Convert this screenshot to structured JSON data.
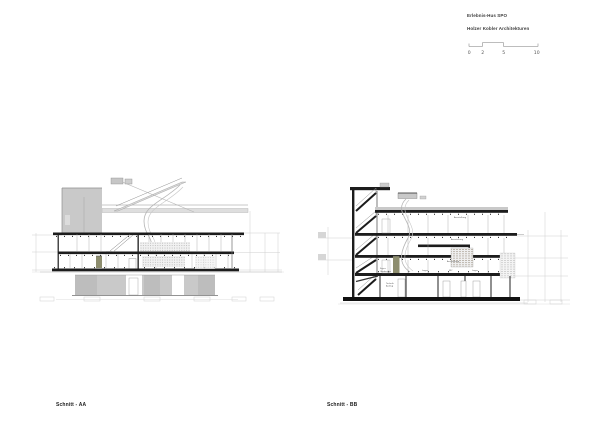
{
  "sheet": {
    "background": "#ffffff"
  },
  "header": {
    "project_title": "Erlebnis-Hus SPO",
    "firm": "Holzer Kobler Architekturen",
    "scale_bar": {
      "ticks": [
        "0",
        "2",
        "5",
        "10"
      ]
    }
  },
  "drawings": {
    "aa": {
      "caption": "Schnitt - AA"
    },
    "bb": {
      "caption": "Schnitt - BB",
      "floor_labels": [
        "Ausstellung",
        "Ausstellung",
        "Ausstellung"
      ],
      "room_labels": [
        "Foyer",
        "Garderobe",
        "Lager",
        "WC",
        "Lager"
      ],
      "basement_labels": [
        "Technik",
        "Aufzug"
      ]
    }
  },
  "colors": {
    "ink": "#1c1c1c",
    "concrete": "#c9c9c9",
    "concrete-dark": "#bdbdbd",
    "olive": "#8d8d6e",
    "faint": "#cfcfcf",
    "label": "#555555",
    "text": "#3b3b3b"
  }
}
